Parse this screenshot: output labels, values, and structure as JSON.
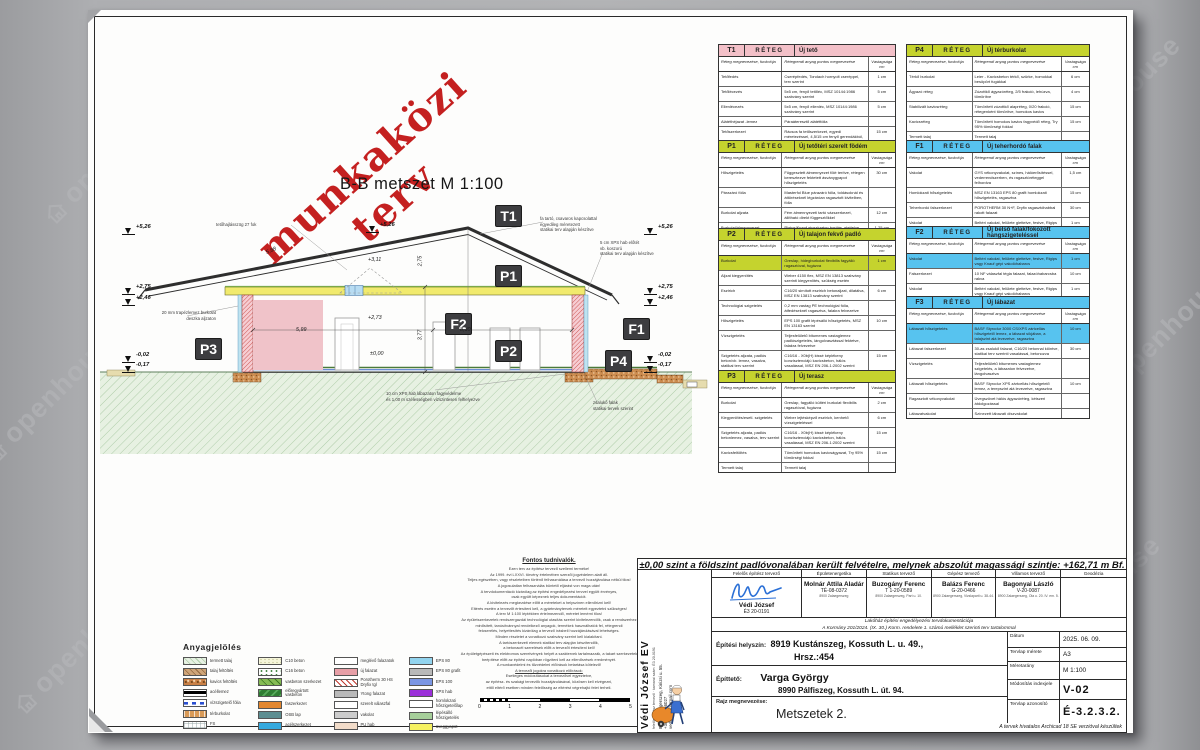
{
  "watermark": {
    "text": "openhouse"
  },
  "stamp": {
    "text": "munkaközi terv"
  },
  "drawing": {
    "title": "B-B metszet M 1:100",
    "chips": [
      {
        "code": "T1",
        "x": 407,
        "y": 195
      },
      {
        "code": "P1",
        "x": 407,
        "y": 255
      },
      {
        "code": "F2",
        "x": 357,
        "y": 303
      },
      {
        "code": "P2",
        "x": 407,
        "y": 330
      },
      {
        "code": "F1",
        "x": 535,
        "y": 308
      },
      {
        "code": "P3",
        "x": 107,
        "y": 328
      },
      {
        "code": "P4",
        "x": 517,
        "y": 340
      }
    ],
    "elev_marks": [
      {
        "t": "+5,26",
        "x": 34,
        "y": 218
      },
      {
        "t": "+2,75",
        "x": 34,
        "y": 278
      },
      {
        "t": "+2,46",
        "x": 34,
        "y": 289
      },
      {
        "t": "-0,02",
        "x": 34,
        "y": 346
      },
      {
        "t": "-0,17",
        "x": 34,
        "y": 356
      },
      {
        "t": "+5,26",
        "x": 278,
        "y": 216
      },
      {
        "t": "+5,26",
        "x": 556,
        "y": 218
      },
      {
        "t": "+2,75",
        "x": 556,
        "y": 278
      },
      {
        "t": "+2,46",
        "x": 556,
        "y": 289
      },
      {
        "t": "-0,02",
        "x": 556,
        "y": 346
      },
      {
        "t": "-0,17",
        "x": 556,
        "y": 356
      }
    ],
    "annotations": [
      {
        "text": "tetőhajlásszög 27 fok",
        "x": 128,
        "y": 212,
        "align": "left"
      },
      {
        "text": "fa tartó, csavaros kapcsolattal\negyedileg méretezett\nstatikai terv alapján készítve",
        "x": 452,
        "y": 206,
        "align": "left"
      },
      {
        "text": "5 cm XPS hab előtét\nvb. koszorú\nstatikai terv alapján készítve",
        "x": 512,
        "y": 230,
        "align": "left"
      },
      {
        "text": "20 mm trapézlemez burkolat\ndeszka aljzaton",
        "x": 28,
        "y": 300,
        "align": "right"
      },
      {
        "text": "10 cm XPS hab lábazaton fagyvédelme\nés 1,00 m szélességben vízszintesen felhelyezve",
        "x": 298,
        "y": 381,
        "align": "left"
      },
      {
        "text": "zsalukő falak\nstatikai tervek szerint",
        "x": 505,
        "y": 390,
        "align": "left"
      }
    ],
    "dims": [
      {
        "t": "5,88",
        "x": 178,
        "y": 238,
        "rot": -23
      },
      {
        "t": "+3,11",
        "x": 280,
        "y": 247,
        "rot": 0
      },
      {
        "t": "+2,73",
        "x": 280,
        "y": 305,
        "rot": 0
      },
      {
        "t": "±0,00",
        "x": 282,
        "y": 341,
        "rot": 0
      },
      {
        "t": "5,99",
        "x": 208,
        "y": 317,
        "rot": 0
      },
      {
        "t": "8,30",
        "x": 372,
        "y": 317,
        "rot": 0
      },
      {
        "t": "2,75",
        "x": 327,
        "y": 248,
        "rot": -90
      },
      {
        "t": "3,77",
        "x": 327,
        "y": 322,
        "rot": -90
      }
    ]
  },
  "layer_headers": {
    "reteg": "RÉTEG",
    "c1": "Réteg megnevezése, funkciója",
    "c2": "Rétegrendi anyag pontos megnevezése",
    "c3": "Vastagsága cm"
  },
  "layer_tables": [
    {
      "code": "T1",
      "title": "Új tető",
      "color": "#f3c0c8",
      "x": 630,
      "y": 34,
      "w": 178,
      "rows": [
        {
          "l": "Tetőfedés",
          "d": "Cserépfedés, Tondach hornyolt cseréppel, terv szerint",
          "v": "1 cm"
        },
        {
          "l": "Tetőlécezés",
          "d": "5x5 cm, fenyő tetőléc, MSZ 10144:1986 szabvány szerint",
          "v": "5 cm"
        },
        {
          "l": "Ellenlécezés",
          "d": "5x5 cm, fenyő ellenléc, MSZ 10144:1986 szabvány szerint",
          "v": "5 cm"
        },
        {
          "l": "Alátéthéjazat -lemez",
          "d": "Páraáteresztő alátétfólia",
          "v": ""
        },
        {
          "l": "Tetőszerkezet",
          "d": "Rácsos fa tetőszerkezet, egyedi méretezéssel, 4,5/15 cm fenyő gerendákból, MSZ 10144:1986 szabvány szerint",
          "v": "15 cm"
        }
      ]
    },
    {
      "code": "P1",
      "title": "Új tetőtéri szerelt födém",
      "color": "#c5d32e",
      "x": 630,
      "y": 130,
      "w": 178,
      "rows": [
        {
          "l": "Hőszigetelés",
          "d": "Függesztett álmennyezet fölé terítve, rétegen keresztezve fektetett ásványgyapot hőszigetelés",
          "v": "30 cm"
        },
        {
          "l": "Párazáró fólia",
          "d": "Masterfol Blue párazáró fólia, toldásoknál és áttöréseknél légzáróan ragasztott kivitelben, fólia",
          "v": ""
        },
        {
          "l": "Burkolat aljzata",
          "d": "Fém álmennyezeti tartó vázszerkezet, állítható direkt függesztőkkel",
          "v": "12 cm"
        },
        {
          "l": "Burkolat/álmennyezet",
          "d": "Rigips/Knauf gipszkarton borítás, glettelve, festve",
          "v": "1,25 cm"
        }
      ]
    },
    {
      "code": "P2",
      "title": "Új talajon fekvő padló",
      "color": "#c5d32e",
      "x": 630,
      "y": 218,
      "w": 178,
      "rows": [
        {
          "l": "Burkolat",
          "d": "Greslap, hidegburkolat flexibilis fagyálló ragasztóval, fugázva",
          "v": "1 cm",
          "h": true
        },
        {
          "l": "Aljzat kiegyenlítés",
          "d": "Weber 4150 flex, MSZ EN 13813 szabvány szerinti kiegyenlítés, szükség esetén",
          "v": ""
        },
        {
          "l": "Esztrich",
          "d": "C16/20 simított esztrich betonaljzat, dilatálva, MSZ EN 13813 szabvány szerint",
          "v": "6 cm"
        },
        {
          "l": "Technológiai szigetelés",
          "d": "0,2 mm vastag PE technológiai fólia, átfedéseknél ragasztva, falakra felvezetve",
          "v": ""
        },
        {
          "l": "Hőszigetelés",
          "d": "EPS 100 grafit lépésálló hőszigetelés, MSZ EN 13163 szerint",
          "v": "10 cm"
        },
        {
          "l": "Vízszigetelés",
          "d": "Teljesfelületű bitumenes vastaglemez padlószigetelés, lángolvasztással fektetve, falakra felvezetve",
          "v": ""
        },
        {
          "l": "Szigetelés aljzata, padlós beton/vb. lemez, vasalva, statikai terv szerint",
          "d": "C16/16 - X0b(H) kissé képlékeny konzisztenciájú kavicsbeton, hálós vasalással, MSZ EN 206-1:2002 szerint",
          "v": "15 cm"
        },
        {
          "l": "Kavicságyazat",
          "d": "Tömörített homokos kavics ágyazat, Trγ 95% tömörségi fokkal",
          "v": "15  cm"
        },
        {
          "l": "Termett talaj",
          "d": "Termett talaj",
          "v": ""
        }
      ]
    },
    {
      "code": "P3",
      "title": "Új terasz",
      "color": "#c5d32e",
      "x": 630,
      "y": 360,
      "w": 178,
      "rows": [
        {
          "l": "Burkolat",
          "d": "Greslap, fagyálló kültéri burkolat flexibilis ragasztóval, fugázva",
          "v": "2 cm"
        },
        {
          "l": "Kiegyenlítés/esetl. szigetelés",
          "d": "Weber lejtésképző esztrich, kenhető vízszigeteléssel",
          "v": "6 cm"
        },
        {
          "l": "Szigetelés aljzata, padlós betonlemez, vasalva, terv szerint",
          "d": "C16/16 - X0b(H) kissé képlékeny konzisztenciájú kavicsbeton, hálós vasalással, MSZ EN 206-1:2002 szerint",
          "v": "15 cm"
        },
        {
          "l": "Kavicsfeltöltés",
          "d": "Tömörített homokos kavicságyazat, Trγ 95% tömörségi fokkal",
          "v": "15  cm"
        },
        {
          "l": "Termett talaj",
          "d": "Termett talaj",
          "v": ""
        }
      ]
    },
    {
      "code": "P4",
      "title": "Új térburkolat",
      "color": "#c5d32e",
      "x": 818,
      "y": 34,
      "w": 184,
      "rows": [
        {
          "l": "Térkő burkolat",
          "d": "Leier - Kavicsbeton térkő, szürke, homokkal besöpört fugákkal",
          "v": "6 cm"
        },
        {
          "l": "Ágyazó réteg",
          "d": "Zúzottkő ágyazóréteg, 2/5 frakció, lehúzva, tömörítve",
          "v": "4 cm"
        },
        {
          "l": "Stabilizált kavicsréteg",
          "d": "Tömörített zúzottkő alapréteg, 0/20 frakció, rétegenként tömörítve, homokos kavics",
          "v": "15 cm"
        },
        {
          "l": "Kavicsréteg",
          "d": "Tömörített homokos kavics fagyvédő réteg, Trγ 95% tömörségi fokkal",
          "v": "15  cm"
        },
        {
          "l": "Termett talaj",
          "d": "Termett talaj",
          "v": ""
        }
      ]
    },
    {
      "code": "F1",
      "title": "Új teherhordó falak",
      "color": "#57c3ef",
      "x": 818,
      "y": 130,
      "w": 184,
      "rows": [
        {
          "l": "Vakolat",
          "d": "GYS vékonyvakolat, színes, hálóerősítéssel, vederrendszerben, és ragasztóréteggel felhordva",
          "v": "1,5 cm"
        },
        {
          "l": "Homlokzati hőszigetelés",
          "d": "MSZ EN 13163 EPS 80 grafit homlokzati hőszigetelés, ragasztva",
          "v": "15 cm"
        },
        {
          "l": "Teherhordó falszerkezet",
          "d": "POROTHERM 30 N+F, Dryfix ragasztóhabbal rakott falazat",
          "v": "30 cm"
        },
        {
          "l": "Vakolat",
          "d": "Beltéri vakolat, felülete glettelve, festve, Rigips vagy Knauf gépi vakolóhabarcs",
          "v": "1 cm"
        }
      ]
    },
    {
      "code": "F2",
      "title": "Új belső falak/fokozott hangszigeteléssel",
      "color": "#57c3ef",
      "x": 818,
      "y": 216,
      "w": 184,
      "rows": [
        {
          "l": "Vakolat",
          "d": "Beltéri vakolat, felülete glettelve, festve, Rigips vagy Knauf gépi vakolóhabarcs",
          "v": "1 cm",
          "h": true
        },
        {
          "l": "Falszerkezet",
          "d": "10 NF válaszfal tégla falazat, falazóhabarcsba rakva",
          "v": "10 cm"
        },
        {
          "l": "Vakolat",
          "d": "Beltéri vakolat, felülete glettelve, festve, Rigips vagy Knauf gépi vakolóhabarcs",
          "v": "1 cm"
        }
      ]
    },
    {
      "code": "F3",
      "title": "Új lábazat",
      "color": "#57c3ef",
      "x": 818,
      "y": 286,
      "w": 184,
      "rows": [
        {
          "l": "Lábazati hőszigetelés",
          "d": "BASF Styrodur 3000 CS/XPS zártcellás hőszigetelő lemez, a lábazat síkjában, a talajszint alá levezetve, ragasztva",
          "v": "10 cm",
          "h": true
        },
        {
          "l": "Lábazat falszerkezet",
          "d": "30-as zsalukő falazat, C16/20 betonnal kiöntve, statikai terv szerinti vasalással, betonozva",
          "v": "30 cm"
        },
        {
          "l": "Vízszigetelés",
          "d": "Teljesfelületű bitumenes vastaglemez szigetelés, a lábazaton felvezetve, lángolvasztva",
          "v": ""
        },
        {
          "l": "Lábazati hőszigetelés",
          "d": "BASF Styrodur XPS zártcellás hőszigetelő lemez, a terepszint alá levezetve, ragasztva",
          "v": "10 cm"
        },
        {
          "l": "Ragasztott vékonyvakolat",
          "d": "Üvegszövet hálós ágyazóréteg, kétszeri átdolgozással",
          "v": ""
        },
        {
          "l": "Lábazatvakolat",
          "d": "Színezett lábazati díszvakolat",
          "v": ""
        }
      ]
    }
  ],
  "legend": {
    "title": "Anyagjelölés",
    "columns": [
      [
        {
          "label": "termett talaj",
          "sw": "hatchgreen"
        },
        {
          "label": "talaj feltöltés",
          "sw": "hatchbrown"
        },
        {
          "label": "kavics feltöltés",
          "sw": "gravel"
        },
        {
          "label": "acéllemez",
          "sw": "solidline"
        },
        {
          "label": "vízszigetelő fólia",
          "sw": "dashblue"
        },
        {
          "label": "térburkolat",
          "sw": "brick"
        },
        {
          "label": "FS",
          "sw": "grid"
        }
      ],
      [
        {
          "label": "C10 beton",
          "sw": "speckle"
        },
        {
          "label": "C16 beton",
          "sw": "specklegreen"
        },
        {
          "label": "vasbeton szerkezet",
          "sw": "rcgreen"
        },
        {
          "label": "előregyártott vasbeton",
          "sw": "darkgreen"
        },
        {
          "label": "faszerkezet",
          "sw": "wood"
        },
        {
          "label": "OSB lap",
          "sw": "osb"
        },
        {
          "label": "acélszerkezet",
          "sw": "steel"
        }
      ],
      [
        {
          "label": "meglévő falazatok",
          "sw": "white"
        },
        {
          "label": "új falazat",
          "sw": "pink"
        },
        {
          "label": "Porotherm 30 HS Dryfix tgl",
          "sw": "redhatch"
        },
        {
          "label": "Ytong falazat",
          "sw": "gray"
        },
        {
          "label": "szerelt válaszfal",
          "sw": "white"
        },
        {
          "label": "vakolat",
          "sw": "gray2"
        },
        {
          "label": "PU hab",
          "sw": "peach"
        }
      ],
      [
        {
          "label": "EPS 80",
          "sw": "lblue"
        },
        {
          "label": "EPS 80 grafit",
          "sw": "gray"
        },
        {
          "label": "EPS 100",
          "sw": "blue"
        },
        {
          "label": "XPS hab",
          "sw": "purple"
        },
        {
          "label": "homlokzati hőszigetelőlap",
          "sw": "white"
        },
        {
          "label": "lépésálló hőszigetelés",
          "sw": "green"
        },
        {
          "label": "üveggyapot",
          "sw": "yellow"
        }
      ]
    ]
  },
  "notes": {
    "title": "Fontos tudnivalók.",
    "lines": [
      "Ezen terv az építész tervező szellemi terméke!",
      "Az 1999. évi LXXVI. törvény értelmében szerzői jogvédelem alatt áll.",
      "Teljes egészében, vagy részleteiben történő felhasználása a tervező hozzájárulása nélkül tilos!",
      "A jogosulatlan felhasználás büntető eljárást von maga után!",
      "A tervdokumentáció kizárólag az építési engedélyezési tervvel együtt érvényes,",
      "csak együtt képeznek teljes dokumentációt.",
      "A kivitelezés megkezdése előtt a méreteket a helyszínen ellenőrizni kell!",
      "Eltérés esetén a tervezőt értesíteni kell, a gyártmánytervek méreteit egyeztetni szükséges!",
      "A terv M 1:100 léptékben értelmezendő, méretet lemérni tilos!",
      "Az épületszerkezetek rendszergazdái technológiai utasítás szerint kivitelezendők, csak a rendszerhez",
      "minősített, tanúsítvánnyal rendelkező anyagok, termékek használhatók fel, rétegrendi",
      "felcserélés, helyettesítés kizárólag a tervező írásbeli hozzájárulásával lehetséges.",
      "Minden részletet a vonatkozó szabvány szerint kell kialakítani.",
      "A tartószerkezeti elemek statikai terv alapján készítendők,",
      "a betonacél szerelések előtt a tervezőt értesíteni kell!",
      "Az épületgépészeti és elektromos szerelvények helyét a szaktervek tartalmazzák, a takart szerkezetek",
      "beépítése előtt az építési naplóban rögzíteni kell az ellenőrzések eredményét.",
      "A munkavédelmi és tűzvédelmi előírások betartása kötelező!",
      "A tervezői jogokra vonatkozó előírások:",
      "Esetleges módosításokat a tervezővel egyeztetve,",
      "az építész- és szakági tervezők hozzájárulásával, közösen kell elvégezni,",
      "ettől eltérő esetben minden felelősség az eltérést végrehajtó felet terheli."
    ],
    "scale_labels": [
      "0",
      "1",
      "2",
      "3",
      "4",
      "5"
    ]
  },
  "tb": {
    "zero_line": "±0,00 szint a földszint padlóvonalában került felvételre, melynek abszolút magassági szintje: +162,71 m Bf.",
    "company": {
      "name": "Védi József EV",
      "sub1": "felelős építész tervező",
      "sub2": "kamarai szám: É3 20-0191",
      "addr": "8900 Zalaegerszeg, Kinizsi u. 55.\n+36-30-5056027\nvedijozsef@gmail.com"
    },
    "signers": [
      {
        "role": "Felelős építész tervező",
        "name": "Védi József",
        "reg": "É3 20-0191",
        "addr": "",
        "sig": true
      },
      {
        "role": "Épületenergetika",
        "name": "Molnár Attila Aladár",
        "reg": "TÉ-08-0372",
        "addr": "8900 Zalaegerszeg"
      },
      {
        "role": "Statikus tervező",
        "name": "Buzogány Ferenc",
        "reg": "T 1-20-0589",
        "addr": "8900 Zalaegerszeg, Part u. 10."
      },
      {
        "role": "Gépész tervező",
        "name": "Balázs Ferenc",
        "reg": "G-20-0466",
        "addr": "8900 Zalaegerszeg, Vizslaparti u. 38-44."
      },
      {
        "role": "Villamos tervező",
        "name": "Bagonyai László",
        "reg": "V-20-0087",
        "addr": "8900 Zalaegerszeg, Ola u. 20. IV. em. 5."
      },
      {
        "role": "Geodézia",
        "name": "",
        "reg": "",
        "addr": ""
      }
    ],
    "doc1": "Lakóház építési engedélyezési tervdokumentációja",
    "doc2": "A Kormány 201/2024. (IX. 30.) Korm. rendelete 1. számú melléklet szerinti terv tartalommal",
    "site_label": "Építési helyszín:",
    "site1": "8919 Kustánszeg, Kossuth L. u. 49.,",
    "site2": "Hrsz.:454",
    "client_label": "Építtető:",
    "client_name": "Varga György",
    "client_addr": "8990 Pálfiszeg, Kossuth L. út. 94.",
    "drawing_label": "Rajz megnevezése:",
    "drawing_name": "Metszetek 2.",
    "meta": [
      {
        "label": "Dátum",
        "value": "2025. 06. 09.",
        "big": false
      },
      {
        "label": "Tervlap mérete",
        "value": "A3",
        "big": false
      },
      {
        "label": "Méretarány",
        "value": "M  1:100",
        "big": false
      },
      {
        "label": "Módosítás indexjele",
        "value": "V-02",
        "big": true
      },
      {
        "label": "Tervlap azonosító",
        "value": "É-3.2.3.2.",
        "big": true
      }
    ],
    "footer": "A tervek hivatalos Archicad 18 SE verzióval készültek"
  }
}
